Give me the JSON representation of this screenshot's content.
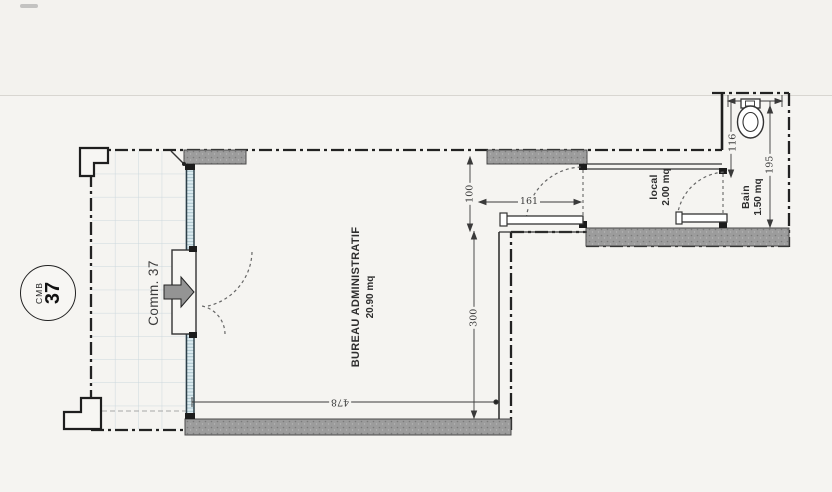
{
  "plan": {
    "badge": {
      "prefix": "CMB",
      "number": "37"
    },
    "entrance_label": "Comm. 37",
    "rooms": {
      "bureau": {
        "name": "BUREAU ADMINISTRATIF",
        "area": "20.90 mq"
      },
      "local": {
        "name": "local",
        "area": "2.00 mq"
      },
      "bain": {
        "name": "Bain",
        "area": "1.50 mq"
      }
    },
    "dimensions": {
      "front_width": "478",
      "room_depth": "300",
      "top_recess": "100",
      "door_span": "161",
      "bain_width": "116",
      "bain_depth": "195"
    },
    "colors": {
      "wall_gray": "#9c9c9c",
      "glass_teal": "#dcebf0",
      "grid_blue": "#ccd7dd",
      "line_dark": "#222222"
    }
  }
}
